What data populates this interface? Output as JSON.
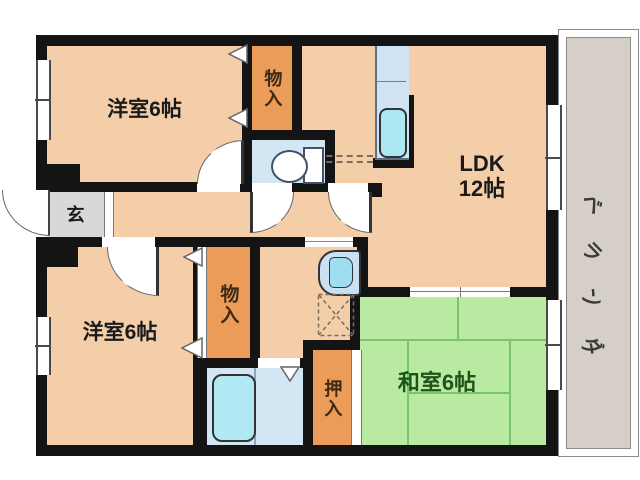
{
  "plan": {
    "labels": {
      "bedroom_top": "洋室6帖",
      "bedroom_bottom": "洋室6帖",
      "ldk_line1": "LDK",
      "ldk_line2": "12帖",
      "washitsu": "和室6帖",
      "closet_top": "物入",
      "closet_bottom": "物入",
      "oshiire": "押入",
      "genkan": "玄",
      "veranda_char_1": "ベ",
      "veranda_char_2": "ラ",
      "veranda_char_3": "ン",
      "veranda_char_4": "ダ"
    },
    "colors": {
      "wall": "#141414",
      "room_floor": "#f4cda9",
      "closet_orange": "#ec9c59",
      "tatami_green": "#b9eaa2",
      "tatami_line": "#7cc46c",
      "tatami_text": "#1c541c",
      "water_room_blue": "#d2e6f4",
      "fixture_cyan": "#aee9f4",
      "entrance_gray": "#d8d8d8",
      "veranda_gray": "#d5cfc8"
    }
  }
}
